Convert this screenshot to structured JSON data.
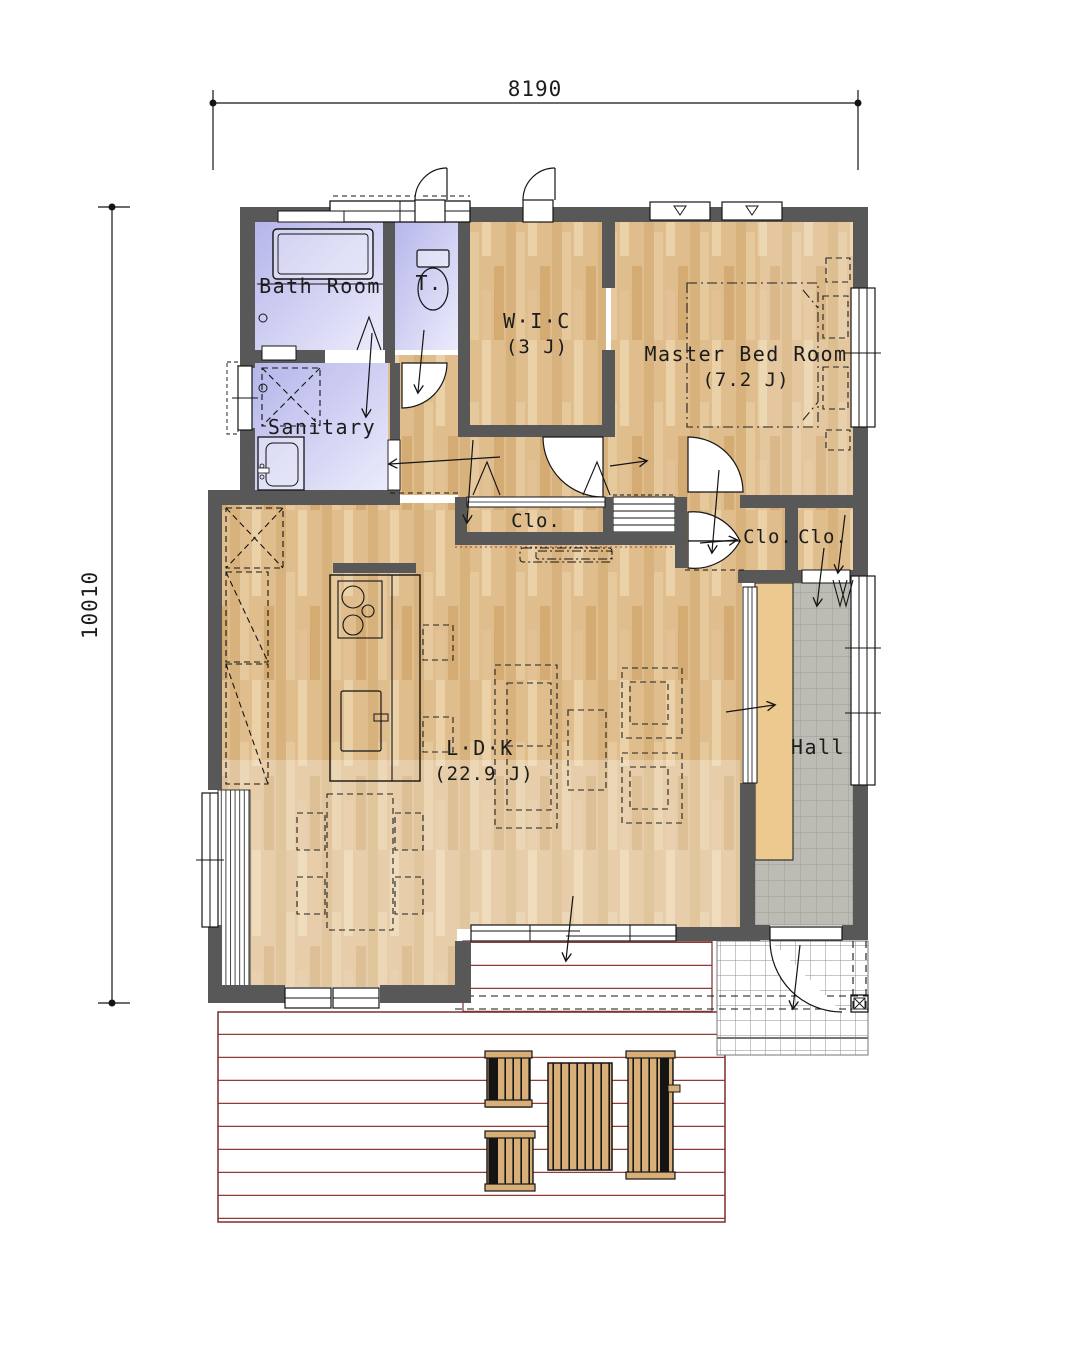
{
  "drawing": {
    "type": "floor-plan",
    "dimensions": {
      "top_mm": "8190",
      "left_mm": "10010"
    },
    "rooms": {
      "bath": {
        "label": "Bath Room"
      },
      "toilet": {
        "label": "T."
      },
      "sanitary": {
        "label": "Sanitary"
      },
      "wic": {
        "label": "W·I·C",
        "area": "(3 J)"
      },
      "master": {
        "label": "Master Bed Room",
        "area": "(7.2 J)"
      },
      "closet_mid": {
        "label": "Clo."
      },
      "closet_left": {
        "label": "Clo."
      },
      "closet_right": {
        "label": "Clo."
      },
      "ldk": {
        "label": "L·D·K",
        "area": "(22.9 J)"
      },
      "hall": {
        "label": "Hall"
      }
    },
    "colors": {
      "wall": "#585858",
      "wood_floor": "#dfbd8d",
      "wet_room": "#bdbdee",
      "hall_tile": "#bcbcb4",
      "deck_line": "#8f3b36",
      "outdoor_furniture": "#d9af79"
    }
  }
}
